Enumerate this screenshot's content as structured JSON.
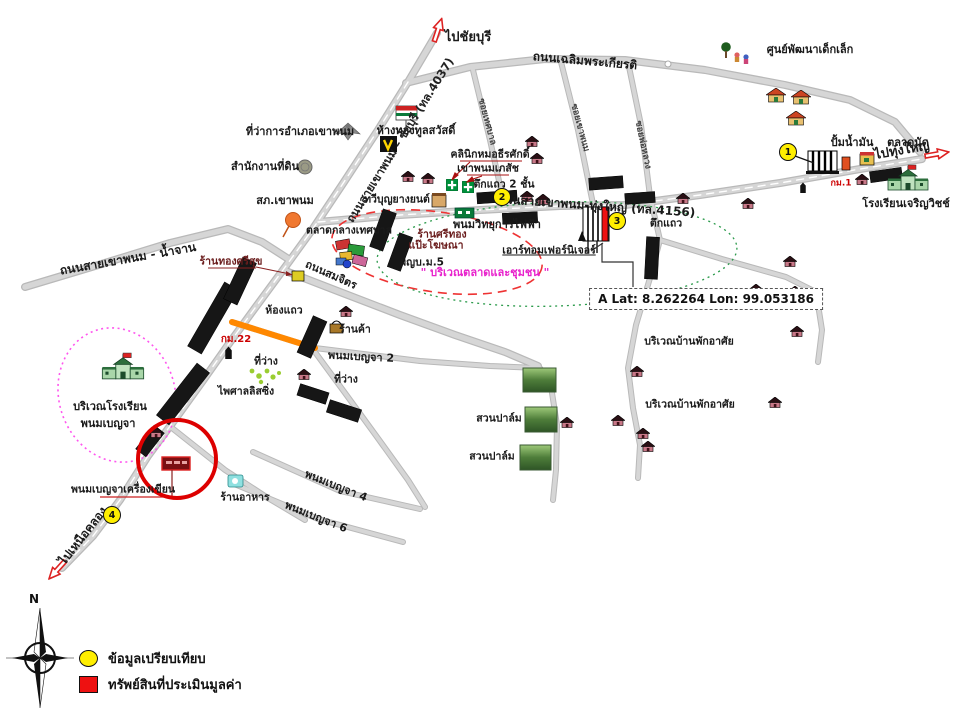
{
  "map_title": "แผนที่แสดงที่ตั้งทรัพย์สิน เขาพนม",
  "labels": {
    "to_chaiburi": {
      "text": "ไปชัยบุรี"
    },
    "to_thungyai": {
      "text": "ไปทุ่งใหญ่"
    },
    "to_nuakhlong": {
      "text": "ไปเหนือคลอง"
    },
    "rd_chalermprakiat": {
      "text": "ถนนเฉลิมพระเกียรติ"
    },
    "rd_4037": {
      "text": "ถนนสายเขาพนม – ชัยบุรี (ทล.4037)"
    },
    "rd_4156": {
      "text": "ถนนสายเขาพนม-ทุ่งใหญ่ (ทล.4156)"
    },
    "rd_namchan": {
      "text": "ถนนสายเขาพนม - น้ำจาน"
    },
    "rd_somchit": {
      "text": "ถนนสมจิตร"
    },
    "rd_benja2": {
      "text": "พนมเบญจา 2"
    },
    "rd_benja4": {
      "text": "พนมเบญจา 4"
    },
    "rd_benja6": {
      "text": "พนมเบญจา 6"
    },
    "soi1": {
      "text": "ซอยเทศบาล"
    },
    "soi2": {
      "text": "ซอยเขาพนม"
    },
    "soi3": {
      "text": "ซอยพ่อหลวง"
    },
    "child_center": {
      "text": "ศูนย์พัฒนาเด็กเล็ก"
    },
    "district_office": {
      "text": "ที่ว่าการอำเภอเขาพนม"
    },
    "gold_toon": {
      "text": "ห้างทองทูลสวัสดิ์"
    },
    "land_office": {
      "text": "สำนักงานที่ดิน"
    },
    "police": {
      "text": "สภ.เขาพนม"
    },
    "tawee": {
      "text": "ทวีบุญยางยนต์"
    },
    "clinic": {
      "text": "คลินิกหมอธีรศักดิ์"
    },
    "pharmacy": {
      "text": "เขาพนมเภสัช"
    },
    "rowhouse2fl": {
      "text": "ตึกแถว 2 ชั้น"
    },
    "phanom_radio": {
      "text": "พนมวิทยุการไฟฟ้า"
    },
    "market": {
      "text": "ตลาดกลางเทศบาล"
    },
    "srithong": {
      "text": "ร้านศรีทอง"
    },
    "pae_ads": {
      "text": "แป๊ะโฆษณา"
    },
    "headman": {
      "text": "ผญบ.ม.5"
    },
    "furniture": {
      "text": "เอาร์ทอมเฟอร์นิเจอร์"
    },
    "market_zone": {
      "text": "\" บริเวณตลาดและชุมชน \""
    },
    "tuek_right": {
      "text": "ตึกแถว"
    },
    "gas": {
      "text": "ปั้มน้ำมัน"
    },
    "talatnat": {
      "text": "ตลาดนัด"
    },
    "km1": {
      "text": "กม.1"
    },
    "km22": {
      "text": "กม.22"
    },
    "school_charoen": {
      "text": "โรงเรียนเจริญวิชช์"
    },
    "residential1": {
      "text": "บริเวณบ้านพักอาศัย"
    },
    "residential2": {
      "text": "บริเวณบ้านพักอาศัย"
    },
    "palm1": {
      "text": "สวนปาล์ม"
    },
    "palm2": {
      "text": "สวนปาล์ม"
    },
    "hongthaeo": {
      "text": "ห้องแถว"
    },
    "rankha": {
      "text": "ร้านค้า"
    },
    "srisuk": {
      "text": "ร้านทองศรีสุข"
    },
    "tiwang1": {
      "text": "ที่ว่าง"
    },
    "tiwang2": {
      "text": "ที่ว่าง"
    },
    "paisan": {
      "text": "ไพศาลลิสซิ่ง"
    },
    "school_zone1": {
      "text": "บริเวณโรงเรียน"
    },
    "school_zone2": {
      "text": "พนมเบญจา"
    },
    "stationery": {
      "text": "พนมเบญจาเครื่องเขียน"
    },
    "restaurant": {
      "text": "ร้านอาหาร"
    }
  },
  "markers": {
    "m1": {
      "label": "1"
    },
    "m2": {
      "label": "2"
    },
    "m3": {
      "label": "3"
    },
    "m4": {
      "label": "4"
    }
  },
  "coordinate_box": {
    "text": "A Lat: 8.262264 Lon: 99.053186"
  },
  "legend": {
    "comparison": "ข้อมูลเปรียบเทียบ",
    "appraised": "ทรัพย์สินที่ประเมินมูลค่า"
  },
  "compass": {
    "north": "N"
  },
  "icons": {
    "compass-rose": "4-point star with ring",
    "school-icon": "green schoolhouse with red flag",
    "house-icon": "small maroon house",
    "row-building-icon": "black shophouse strip",
    "green-cross-icon": "pharmacy cross",
    "gas-station-icon": "striped canopy building",
    "tree-icon": "green tree",
    "milestone-icon": "black km post",
    "direction-arrow-icon": "red outlined arrow",
    "target-circle-icon": "red circle around appraised property"
  },
  "colors": {
    "road": "#cfcfcf",
    "road_edge": "#b9b9b9",
    "orange_segment": "#ff8800",
    "target_red": "#dd0000",
    "marker_yellow": "#ffee00",
    "school_zone_pink": "#ff55ee",
    "market_zone_green": "#2a9a4a",
    "market_zone_red_dash": "#ee3333",
    "legend_red": "#ee1111",
    "magenta_text": "#e822cc"
  }
}
